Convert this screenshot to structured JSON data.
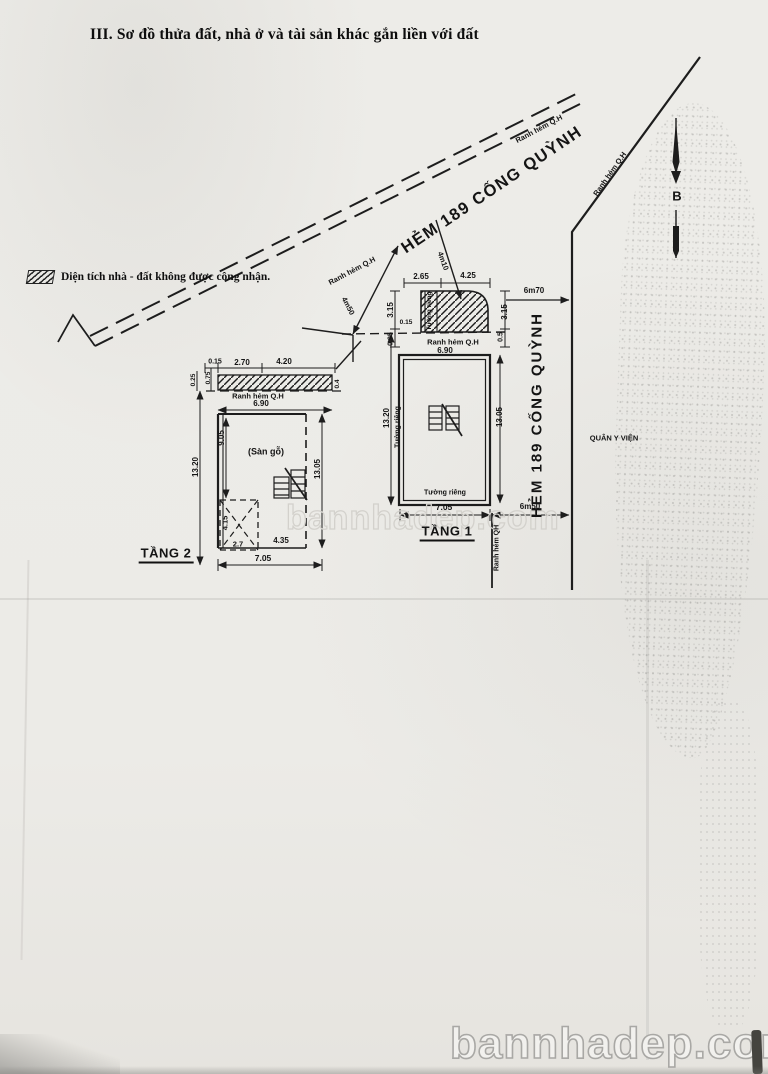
{
  "page": {
    "title": "III. Sơ đồ thửa đất, nhà ở và tài sản khác gắn liền với đất"
  },
  "legend": {
    "text": "Diện tích nhà - đất không được công nhận."
  },
  "compass": {
    "north": "B"
  },
  "street": {
    "name": "HẺM 189 CỐNG QUỲNH",
    "boundary": "Ranh hẻm Q.H",
    "boundary_short": "Ranh hẻm QH",
    "width_upper": "6m70",
    "width_lower": "6m50",
    "setback_left": "4m50",
    "setback_right": "4m10",
    "hospital": "QUÂN Y VIỆN"
  },
  "floor1": {
    "name": "TẦNG 1",
    "wall": "Tường riêng",
    "dims": {
      "top1": "2.65",
      "top2": "4.25",
      "left_a": "3.15",
      "left_b": "0.95",
      "offset": "0.15",
      "right_a": "3.15",
      "right_b": "0.5",
      "front": "6.90",
      "back": "7.05",
      "side_left": "13.20",
      "side_right": "13.05"
    }
  },
  "floor2": {
    "name": "TẦNG 2",
    "room": "(Sàn gỗ)",
    "dims": {
      "top0": "0.15",
      "top1": "2.70",
      "top2": "4.20",
      "left_a": "0.25",
      "left_b": "0.75",
      "right_a": "0.4",
      "front": "6.90",
      "back": "7.05",
      "side_left": "13.20",
      "side_inner": "9.05",
      "side_right": "13.05",
      "void_h": "4.15",
      "void_w": "2.7",
      "seg": "4.35"
    }
  },
  "watermark": {
    "text": "bannhadep.com"
  }
}
